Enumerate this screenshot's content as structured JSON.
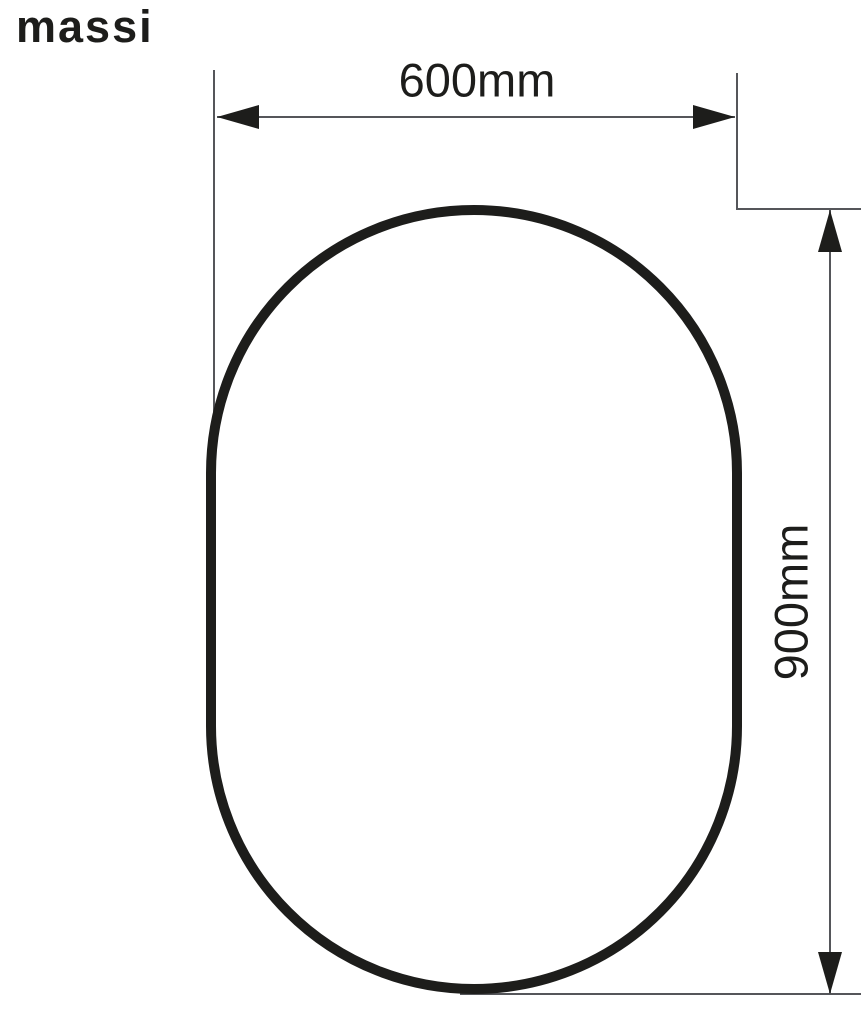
{
  "colors": {
    "ink": "#1d1d1b",
    "line": "#55565a",
    "background": "#ffffff"
  },
  "brand": {
    "logo_text": "massi"
  },
  "diagram": {
    "shape": "oval-mirror-outline",
    "width_dimension": {
      "value": "600mm"
    },
    "height_dimension": {
      "value": "900mm"
    }
  }
}
